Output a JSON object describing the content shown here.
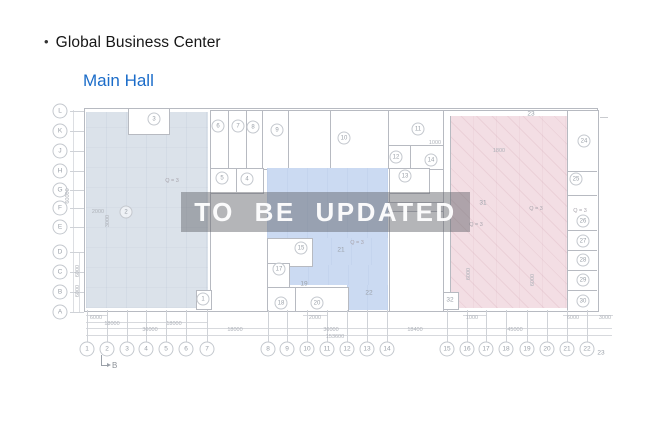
{
  "header": {
    "bullet": "•",
    "title": "Global Business Center",
    "subtitle": "Main Hall"
  },
  "watermark": {
    "text": "TO BE UPDATED"
  },
  "colors": {
    "subtitle_blue": "#1b6cc9",
    "zone_left": "#dbe2ea",
    "zone_middle": "#cbdaf2",
    "zone_right": "#f3dee4",
    "wall_gray": "#b7bac1",
    "label_gray": "#9aa0a8",
    "watermark_band": "rgba(95,98,104,0.47)"
  },
  "plan": {
    "row_labels": [
      {
        "t": "L",
        "x": 60,
        "y": 111
      },
      {
        "t": "K",
        "x": 60,
        "y": 131
      },
      {
        "t": "J",
        "x": 60,
        "y": 151
      },
      {
        "t": "H",
        "x": 60,
        "y": 171
      },
      {
        "t": "G",
        "x": 60,
        "y": 190
      },
      {
        "t": "F",
        "x": 60,
        "y": 208
      },
      {
        "t": "E",
        "x": 60,
        "y": 227
      },
      {
        "t": "D",
        "x": 60,
        "y": 252
      },
      {
        "t": "C",
        "x": 60,
        "y": 272
      },
      {
        "t": "B",
        "x": 60,
        "y": 292
      },
      {
        "t": "A",
        "x": 60,
        "y": 312
      }
    ],
    "col_labels": [
      {
        "t": "1",
        "x": 87,
        "y": 349
      },
      {
        "t": "2",
        "x": 107,
        "y": 349
      },
      {
        "t": "3",
        "x": 127,
        "y": 349
      },
      {
        "t": "4",
        "x": 146,
        "y": 349
      },
      {
        "t": "5",
        "x": 166,
        "y": 349
      },
      {
        "t": "6",
        "x": 186,
        "y": 349
      },
      {
        "t": "7",
        "x": 207,
        "y": 349
      },
      {
        "t": "8",
        "x": 268,
        "y": 349
      },
      {
        "t": "9",
        "x": 287,
        "y": 349
      },
      {
        "t": "10",
        "x": 307,
        "y": 349
      },
      {
        "t": "11",
        "x": 327,
        "y": 349
      },
      {
        "t": "12",
        "x": 347,
        "y": 349
      },
      {
        "t": "13",
        "x": 367,
        "y": 349
      },
      {
        "t": "14",
        "x": 387,
        "y": 349
      },
      {
        "t": "15",
        "x": 447,
        "y": 349
      },
      {
        "t": "16",
        "x": 467,
        "y": 349
      },
      {
        "t": "17",
        "x": 486,
        "y": 349
      },
      {
        "t": "18",
        "x": 506,
        "y": 349
      },
      {
        "t": "19",
        "x": 527,
        "y": 349
      },
      {
        "t": "20",
        "x": 547,
        "y": 349
      },
      {
        "t": "21",
        "x": 567,
        "y": 349
      },
      {
        "t": "22",
        "x": 587,
        "y": 349
      },
      {
        "t": "23",
        "x": 601,
        "y": 353,
        "plain": true
      }
    ],
    "rooms_circled": [
      {
        "t": "1",
        "x": 203,
        "y": 299
      },
      {
        "t": "2",
        "x": 126,
        "y": 212
      },
      {
        "t": "3",
        "x": 154,
        "y": 119
      },
      {
        "t": "4",
        "x": 247,
        "y": 179
      },
      {
        "t": "5",
        "x": 222,
        "y": 178
      },
      {
        "t": "6",
        "x": 218,
        "y": 126
      },
      {
        "t": "7",
        "x": 238,
        "y": 126
      },
      {
        "t": "8",
        "x": 253,
        "y": 127
      },
      {
        "t": "9",
        "x": 277,
        "y": 130
      },
      {
        "t": "10",
        "x": 344,
        "y": 138
      },
      {
        "t": "11",
        "x": 418,
        "y": 129
      },
      {
        "t": "12",
        "x": 396,
        "y": 157
      },
      {
        "t": "13",
        "x": 405,
        "y": 176
      },
      {
        "t": "14",
        "x": 431,
        "y": 160
      },
      {
        "t": "15",
        "x": 301,
        "y": 248
      },
      {
        "t": "17",
        "x": 279,
        "y": 269
      },
      {
        "t": "18",
        "x": 281,
        "y": 303
      },
      {
        "t": "20",
        "x": 317,
        "y": 303
      },
      {
        "t": "24",
        "x": 584,
        "y": 141
      },
      {
        "t": "25",
        "x": 576,
        "y": 179
      },
      {
        "t": "26",
        "x": 583,
        "y": 221
      },
      {
        "t": "27",
        "x": 583,
        "y": 241
      },
      {
        "t": "28",
        "x": 583,
        "y": 260
      },
      {
        "t": "29",
        "x": 583,
        "y": 280
      },
      {
        "t": "30",
        "x": 583,
        "y": 301
      }
    ],
    "rooms_plain": [
      {
        "t": "19",
        "x": 304,
        "y": 284
      },
      {
        "t": "21",
        "x": 341,
        "y": 250
      },
      {
        "t": "22",
        "x": 369,
        "y": 293
      },
      {
        "t": "23",
        "x": 531,
        "y": 114
      },
      {
        "t": "31",
        "x": 483,
        "y": 203
      },
      {
        "t": "32",
        "x": 450,
        "y": 300
      }
    ],
    "zone_labels": [
      {
        "t": "Q = 3",
        "x": 172,
        "y": 181
      },
      {
        "t": "Q = 3",
        "x": 357,
        "y": 243
      },
      {
        "t": "Q = 3",
        "x": 476,
        "y": 225
      },
      {
        "t": "Q = 3",
        "x": 536,
        "y": 209
      },
      {
        "t": "Q = 3",
        "x": 580,
        "y": 211
      }
    ],
    "inner_dims": [
      {
        "t": "2000",
        "x": 98,
        "y": 212
      },
      {
        "t": "1000",
        "x": 435,
        "y": 143
      },
      {
        "t": "1800",
        "x": 499,
        "y": 151
      }
    ],
    "bottom_dims": [
      {
        "t": "6000",
        "x": 96,
        "y": 318
      },
      {
        "t": "2000",
        "x": 315,
        "y": 318
      },
      {
        "t": "1000",
        "x": 472,
        "y": 318
      },
      {
        "t": "6000",
        "x": 573,
        "y": 318
      },
      {
        "t": "3000",
        "x": 605,
        "y": 318
      },
      {
        "t": "18000",
        "x": 112,
        "y": 324
      },
      {
        "t": "18000",
        "x": 174,
        "y": 324
      },
      {
        "t": "36000",
        "x": 150,
        "y": 330
      },
      {
        "t": "18000",
        "x": 235,
        "y": 330
      },
      {
        "t": "36000",
        "x": 331,
        "y": 330
      },
      {
        "t": "18400",
        "x": 415,
        "y": 330
      },
      {
        "t": "45000",
        "x": 515,
        "y": 330
      },
      {
        "t": "153600",
        "x": 335,
        "y": 337
      }
    ],
    "vertical_dims": [
      {
        "t": "60000",
        "x": 68,
        "y": 196
      },
      {
        "t": "6000",
        "x": 78,
        "y": 271
      },
      {
        "t": "6000",
        "x": 78,
        "y": 291
      },
      {
        "t": "3000",
        "x": 108,
        "y": 221
      },
      {
        "t": "6000",
        "x": 469,
        "y": 274
      },
      {
        "t": "6000",
        "x": 533,
        "y": 280
      }
    ],
    "section_marker": {
      "label": "B"
    }
  }
}
